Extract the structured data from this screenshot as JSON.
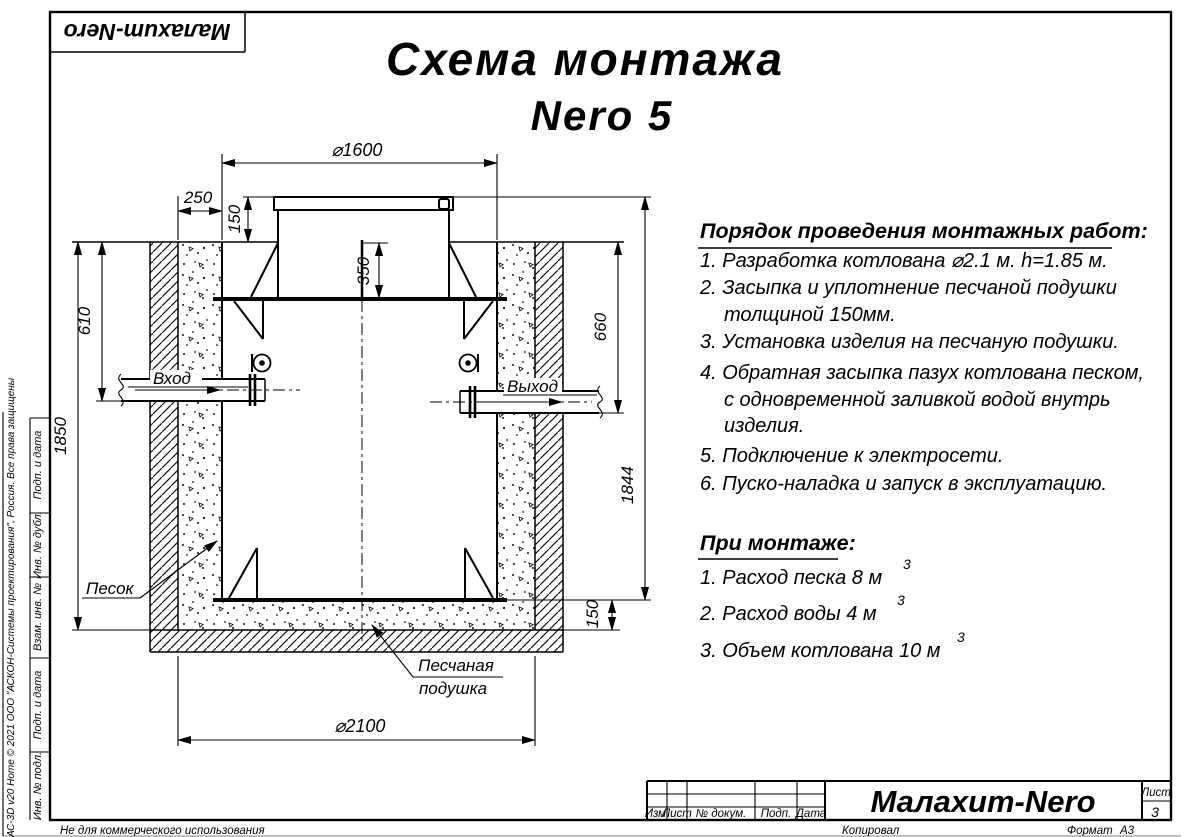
{
  "sheet": {
    "logo": "Малахит-Nero",
    "title_line1": "Схема монтажа",
    "title_line2": "Nero 5",
    "copyright": "КОМПАС-3D v20 Home © 2021 ООО \"АСКОН-Системы проектирования\", Россия. Все права защищены",
    "non_commercial": "Не для коммерческого использования",
    "copied_by": "Копировал",
    "format_label": "Формат",
    "format_value": "А3"
  },
  "side_strip": {
    "cells": [
      "Подп. и дата",
      "Инв. № дубл.",
      "Взам. инв. №",
      "Подп. и дата",
      "Инв. № подл."
    ]
  },
  "title_block": {
    "columns": [
      "Изм.",
      "Лист",
      "№ докум.",
      "Подп.",
      "Дата"
    ],
    "product": "Малахит-Nero",
    "sheet_label": "Лист",
    "sheet_number": "3"
  },
  "instructions": {
    "heading": "Порядок проведения монтажных работ:",
    "items": [
      {
        "lines": [
          "1. Разработка котлована ⌀2.1 м. h=1.85 м."
        ]
      },
      {
        "lines": [
          "2. Засыпка и уплотнение песчаной подушки",
          "толщиной 150мм."
        ]
      },
      {
        "lines": [
          "3. Установка изделия на песчаную подушки."
        ]
      },
      {
        "lines": [
          "4. Обратная засыпка пазух котлована песком,",
          "с одновременной заливкой водой внутрь",
          "изделия."
        ]
      },
      {
        "lines": [
          "5. Подключение к электросети."
        ]
      },
      {
        "lines": [
          "6. Пуско-наладка и запуск в эксплуатацию."
        ]
      }
    ],
    "mounting_heading": "При монтаже:",
    "mounting_items": [
      {
        "text": "1. Расход песка 8 м",
        "sup": "3"
      },
      {
        "text": "2. Расход воды 4 м",
        "sup": "3"
      },
      {
        "text": "3. Объем котлована 10 м",
        "sup": "3"
      }
    ]
  },
  "drawing": {
    "dimensions": {
      "top_diameter": "⌀1600",
      "side_gap": "250",
      "lid_height": "150",
      "neck_depth": "350",
      "inlet_depth": "610",
      "pit_depth": "1850",
      "outlet_depth": "660",
      "tank_height": "1844",
      "cushion_height": "150",
      "pit_diameter": "⌀2100"
    },
    "labels": {
      "inlet": "Вход",
      "outlet": "Выход",
      "sand": "Песок",
      "cushion_line1": "Песчаная",
      "cushion_line2": "подушка"
    }
  }
}
